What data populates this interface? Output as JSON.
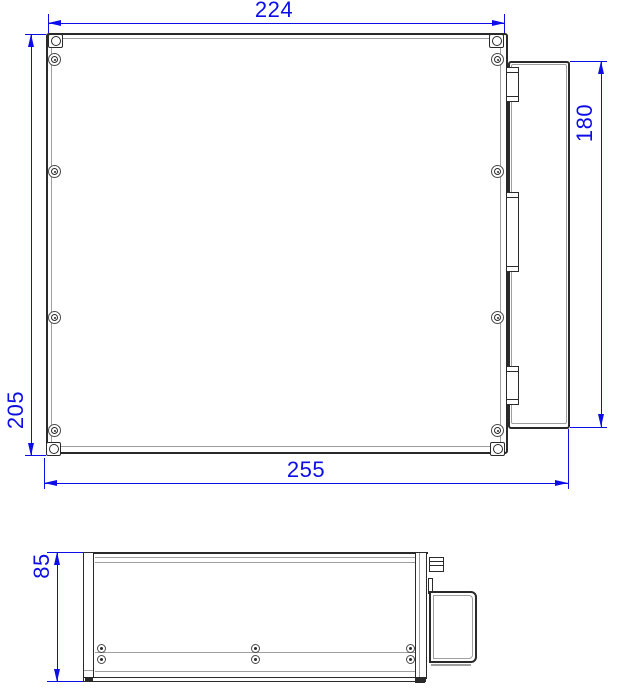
{
  "drawing": {
    "background": "#ffffff",
    "outline_color": "#2a2a2a",
    "secondary_line_color": "#9e9e9e",
    "dimension_color": "#0d0de8",
    "top_view": {
      "dim_width_top": "224",
      "dim_height_left": "205",
      "dim_width_bottom": "255",
      "dim_height_right": "180"
    },
    "side_view": {
      "dim_height_left": "85"
    }
  }
}
